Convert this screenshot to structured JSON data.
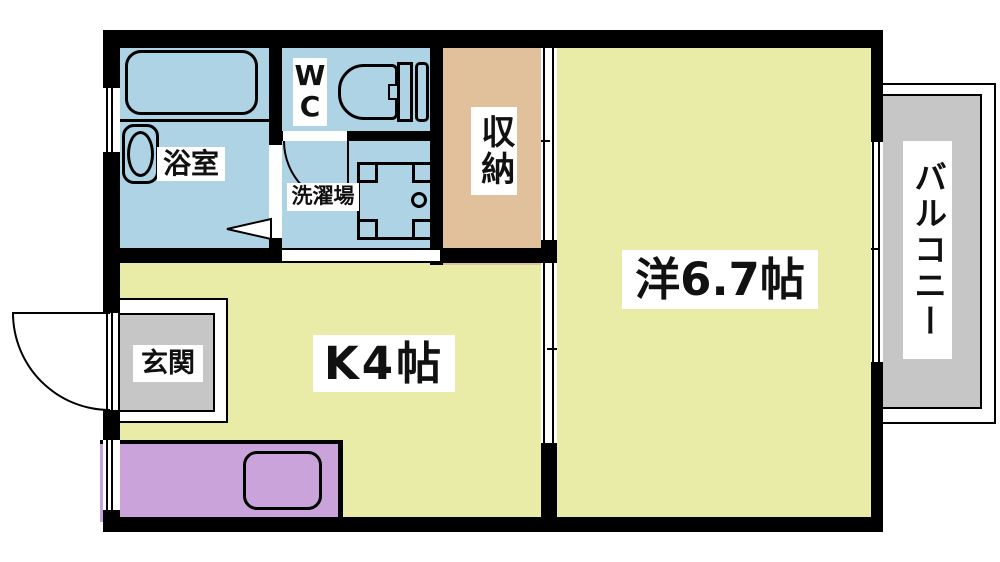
{
  "plan": {
    "type_note": "floor-plan",
    "rooms": {
      "bathroom": {
        "label": "浴室"
      },
      "wc": {
        "label": "WC",
        "label_lines": [
          "W",
          "C"
        ]
      },
      "laundry": {
        "label": "洗濯場"
      },
      "storage": {
        "label": "収納"
      },
      "western_room": {
        "label": "洋6.7帖"
      },
      "kitchen": {
        "label": "K4帖"
      },
      "entrance": {
        "label": "玄関"
      },
      "balcony": {
        "label": "バルコニー"
      }
    }
  },
  "colors": {
    "wall": "#000000",
    "wet": "#aed3e4",
    "room": "#e9eca6",
    "storage": "#e0c19c",
    "gray": "#c6c6c6",
    "counter": "#c9a3da"
  }
}
